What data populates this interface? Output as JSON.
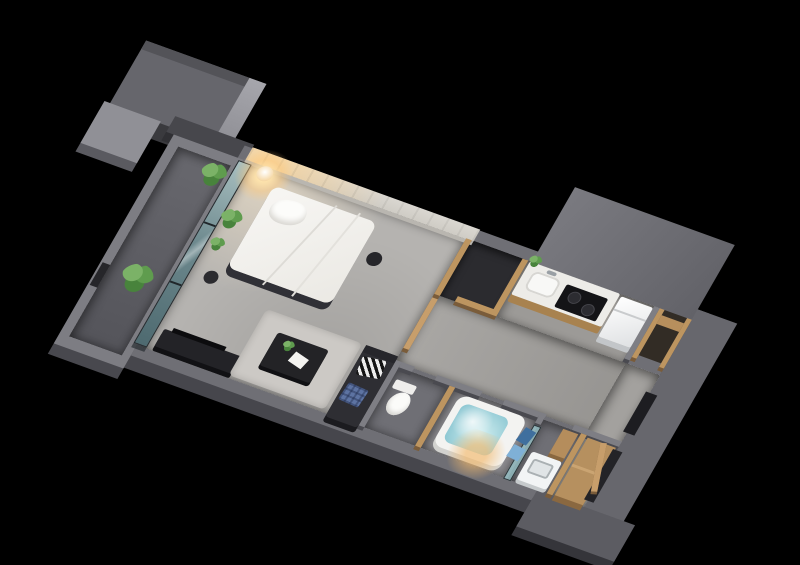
{
  "scene": {
    "title": "studio-apartment-3d-floor-plan",
    "style": "isometric cutaway render on black background",
    "background": "#000000",
    "camera_rotation_deg": 20,
    "rooms": [
      {
        "name": "balcony",
        "floor": "concrete",
        "items": [
          "potted-plant-large",
          "potted-plant-small",
          "parapet-drain-slot"
        ]
      },
      {
        "name": "bedroom-living",
        "floor": "gray-carpet",
        "items": [
          "double-bed",
          "white-pillow",
          "paper-floor-lamp",
          "round-side-table",
          "black-stool",
          "tv-board",
          "area-rug",
          "coffee-table",
          "table-plant",
          "papers",
          "dark-sofa",
          "striped-cushion",
          "blue-plaid-cushion",
          "balcony-glass-door",
          "indoor-plants"
        ]
      },
      {
        "name": "walk-in-closet",
        "floor": "dark",
        "items": [
          "wood-partition-walls"
        ]
      },
      {
        "name": "kitchen",
        "floor": "gray-tile",
        "items": [
          "white-counter",
          "sink",
          "faucet",
          "two-burner-stove",
          "counter-plant",
          "refrigerator",
          "wood-storage-nook"
        ]
      },
      {
        "name": "hallway",
        "floor": "gray-tile",
        "items": [
          "sliding-wood-door"
        ]
      },
      {
        "name": "toilet-room",
        "floor": "herringbone-wood",
        "items": [
          "toilet"
        ]
      },
      {
        "name": "bathroom",
        "floor": "gray-tile",
        "items": [
          "bathtub-with-water",
          "warm-ceiling-light"
        ]
      },
      {
        "name": "laundry",
        "floor": "herringbone-wood",
        "items": [
          "shower-glass-door",
          "blue-towels",
          "washing-machine",
          "wood-vanity"
        ]
      },
      {
        "name": "entry",
        "floor": "gray-tile",
        "items": [
          "wood-step",
          "entry-door",
          "dark-wall-niche"
        ]
      }
    ],
    "palette": {
      "wall_gray": "#6f6f75",
      "wall_dark": "#46464c",
      "wood": "#bd9560",
      "wood_dark": "#8a6840",
      "carpet": "#b5b3b0",
      "concrete_head_wall": "#d8d5cf",
      "glass_teal": "#6d898e",
      "bed_white": "#f3f2ef",
      "water_cyan": "#8ec8d3",
      "lamp_warm": "#ffd896",
      "plant_green": "#5f9c4e",
      "appliance_white": "#f2f4f5",
      "sofa_dark": "#2e2e33",
      "accent_blue": "#5d73a2"
    }
  }
}
